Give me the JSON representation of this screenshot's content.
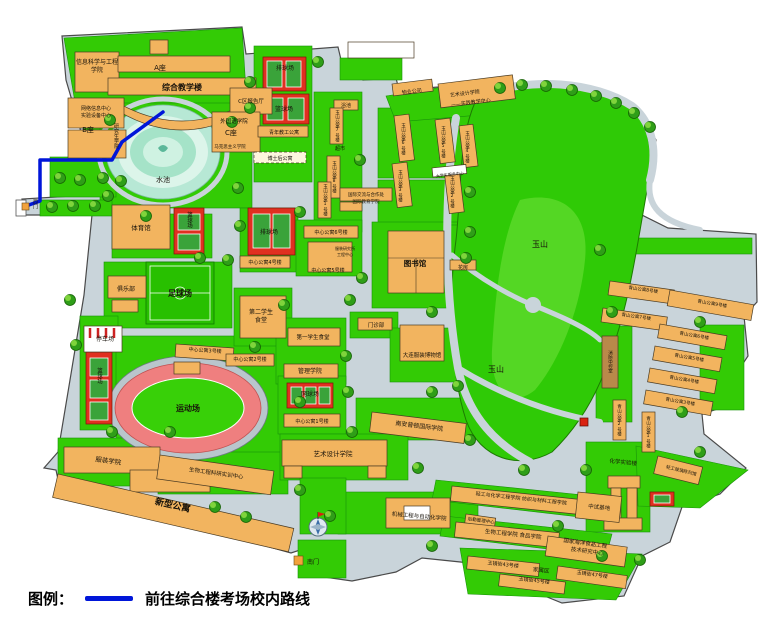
{
  "legend": {
    "prefix": "图例：",
    "route_label": "前往综合楼考场校内路线"
  },
  "colors": {
    "route": "#0016d9",
    "ground": "#c9d4da",
    "green": "#33cb05",
    "building": "#f2b45f",
    "court_red": "#e03020",
    "pond": "#b7e8d5"
  },
  "map": {
    "labels": [
      {
        "t": "信息科学与工程",
        "x": 97,
        "y": 64,
        "fs": 6
      },
      {
        "t": "学院",
        "x": 97,
        "y": 72,
        "fs": 6
      },
      {
        "t": "A座",
        "x": 160,
        "y": 70,
        "fs": 7
      },
      {
        "t": "综合教学楼",
        "x": 182,
        "y": 90,
        "fs": 8,
        "b": 1
      },
      {
        "t": "C区报告厅",
        "x": 251,
        "y": 103,
        "fs": 5.5
      },
      {
        "t": "网络信息中心",
        "x": 96,
        "y": 110,
        "fs": 5
      },
      {
        "t": "实验设备中心",
        "x": 96,
        "y": 117,
        "fs": 5
      },
      {
        "t": "B座",
        "x": 88,
        "y": 132,
        "fs": 7
      },
      {
        "t": "研究生学院",
        "x": 116,
        "y": 136,
        "fs": 5,
        "v": 1
      },
      {
        "t": "外国语学院",
        "x": 234,
        "y": 123,
        "fs": 5.5
      },
      {
        "t": "C座",
        "x": 231,
        "y": 135,
        "fs": 7
      },
      {
        "t": "马克思主义学院",
        "x": 230,
        "y": 148,
        "fs": 4.5
      },
      {
        "t": "水池",
        "x": 163,
        "y": 182,
        "fs": 7,
        "c": "#1c5e4e"
      },
      {
        "t": "西门",
        "x": 35,
        "y": 204,
        "fs": 5,
        "v": 1
      },
      {
        "t": "体育馆",
        "x": 141,
        "y": 230,
        "fs": 6.5
      },
      {
        "t": "篮球场",
        "x": 189,
        "y": 220,
        "fs": 5.5,
        "v": 1,
        "c": "#fff"
      },
      {
        "t": "俱乐部",
        "x": 126,
        "y": 291,
        "fs": 6
      },
      {
        "t": "足球场",
        "x": 180,
        "y": 296,
        "fs": 8,
        "c": "#fff",
        "b": 1
      },
      {
        "t": "停车场",
        "x": 105,
        "y": 341,
        "fs": 6
      },
      {
        "t": "篮球场",
        "x": 99,
        "y": 376,
        "fs": 5.5,
        "v": 1,
        "c": "#fff"
      },
      {
        "t": "运动场",
        "x": 188,
        "y": 411,
        "fs": 8,
        "c": "#7a1800",
        "b": 1
      },
      {
        "t": "服装学院",
        "x": 108,
        "y": 463,
        "fs": 6.5,
        "r": 8
      },
      {
        "t": "生物工程科研实训中心",
        "x": 216,
        "y": 475,
        "fs": 5.5,
        "r": 8
      },
      {
        "t": "新型公寓",
        "x": 172,
        "y": 508,
        "fs": 9,
        "r": 13,
        "b": 1
      },
      {
        "t": "排球场",
        "x": 269,
        "y": 234,
        "fs": 6,
        "c": "#fff"
      },
      {
        "t": "中心公寓4号楼",
        "x": 265,
        "y": 264,
        "fs": 5
      },
      {
        "t": "中心公寓6号楼",
        "x": 331,
        "y": 234,
        "fs": 5
      },
      {
        "t": "中心公寓5号楼",
        "x": 328,
        "y": 272,
        "fs": 5
      },
      {
        "t": "服装研究所",
        "x": 345,
        "y": 250,
        "fs": 4
      },
      {
        "t": "工程中心",
        "x": 345,
        "y": 256,
        "fs": 4
      },
      {
        "t": "图书馆",
        "x": 415,
        "y": 266,
        "fs": 7.5,
        "b": 1
      },
      {
        "t": "花房",
        "x": 463,
        "y": 269,
        "fs": 5
      },
      {
        "t": "第二学生",
        "x": 261,
        "y": 314,
        "fs": 6
      },
      {
        "t": "食堂",
        "x": 261,
        "y": 322,
        "fs": 6
      },
      {
        "t": "第一学生食堂",
        "x": 313,
        "y": 339,
        "fs": 5.5
      },
      {
        "t": "中心公寓3号楼",
        "x": 205,
        "y": 352,
        "fs": 5,
        "r": 4
      },
      {
        "t": "中心公寓2号楼",
        "x": 250,
        "y": 361,
        "fs": 5
      },
      {
        "t": "管理学院",
        "x": 310,
        "y": 373,
        "fs": 6
      },
      {
        "t": "门诊部",
        "x": 376,
        "y": 327,
        "fs": 5.5
      },
      {
        "t": "大连服装博物馆",
        "x": 422,
        "y": 357,
        "fs": 5.5
      },
      {
        "t": "网球场",
        "x": 310,
        "y": 396,
        "fs": 6,
        "c": "#fff"
      },
      {
        "t": "中心公寓1号楼",
        "x": 312,
        "y": 423,
        "fs": 5
      },
      {
        "t": "南安普顿国际学院",
        "x": 419,
        "y": 428,
        "fs": 6,
        "r": 7
      },
      {
        "t": "艺术设计学院",
        "x": 333,
        "y": 456,
        "fs": 6.5
      },
      {
        "t": "机械工程与自动化学院",
        "x": 419,
        "y": 518,
        "fs": 5.5,
        "r": 5
      },
      {
        "t": "后勤管理中心",
        "x": 481,
        "y": 522,
        "fs": 4.5,
        "r": 8
      },
      {
        "t": "南门",
        "x": 313,
        "y": 564,
        "fs": 6
      },
      {
        "t": "排球场",
        "x": 285,
        "y": 70,
        "fs": 6,
        "c": "#fff"
      },
      {
        "t": "篮球场",
        "x": 284,
        "y": 111,
        "fs": 6,
        "c": "#fff"
      },
      {
        "t": "青年教工公寓",
        "x": 284,
        "y": 134,
        "fs": 5
      },
      {
        "t": "博士后公寓",
        "x": 280,
        "y": 160,
        "fs": 5
      },
      {
        "t": "浴池",
        "x": 346,
        "y": 107,
        "fs": 5
      },
      {
        "t": "玉山公寓7号楼",
        "x": 337,
        "y": 126,
        "fs": 4.5,
        "v": 1
      },
      {
        "t": "超市",
        "x": 340,
        "y": 150,
        "fs": 5
      },
      {
        "t": "玉山公寓8号楼",
        "x": 334,
        "y": 177,
        "fs": 4.5,
        "v": 1
      },
      {
        "t": "玉山公寓1号楼",
        "x": 325,
        "y": 200,
        "fs": 4.5,
        "v": 1
      },
      {
        "t": "国际交流与合作处",
        "x": 366,
        "y": 196,
        "fs": 4.5
      },
      {
        "t": "国际教育学院",
        "x": 366,
        "y": 203,
        "fs": 4.5
      },
      {
        "t": "物业公司",
        "x": 412,
        "y": 93,
        "fs": 5,
        "r": -7
      },
      {
        "t": "艺术设计学院",
        "x": 465,
        "y": 95,
        "fs": 5,
        "r": -7
      },
      {
        "t": "——实践教学中心",
        "x": 471,
        "y": 104,
        "fs": 5,
        "r": -7
      },
      {
        "t": "玉山公寓6号楼",
        "x": 403,
        "y": 139,
        "fs": 4.5,
        "v": 1
      },
      {
        "t": "玉山公寓5号楼",
        "x": 443,
        "y": 142,
        "fs": 4.5,
        "v": 1
      },
      {
        "t": "玉山公寓4号楼",
        "x": 467,
        "y": 147,
        "fs": 4.5,
        "v": 1
      },
      {
        "t": "玉山公寓3号楼",
        "x": 400,
        "y": 186,
        "fs": 4.5,
        "v": 1
      },
      {
        "t": "玉山公寓2号楼",
        "x": 452,
        "y": 192,
        "fs": 4.5,
        "v": 1
      },
      {
        "t": "大学生服务中心",
        "x": 450,
        "y": 176,
        "fs": 4,
        "r": -6
      },
      {
        "t": "玉山",
        "x": 540,
        "y": 247,
        "fs": 8
      },
      {
        "t": "玉山",
        "x": 496,
        "y": 372,
        "fs": 8
      },
      {
        "t": "青山公寓8号楼",
        "x": 643,
        "y": 291,
        "fs": 4.5,
        "r": 8
      },
      {
        "t": "青山公寓7号楼",
        "x": 636,
        "y": 318,
        "fs": 4.5,
        "r": 8
      },
      {
        "t": "青山公寓9号楼",
        "x": 712,
        "y": 305,
        "fs": 4.5,
        "r": 10
      },
      {
        "t": "青山公寓6号楼",
        "x": 694,
        "y": 337,
        "fs": 4.5,
        "r": 10
      },
      {
        "t": "青山公寓5号楼",
        "x": 689,
        "y": 359,
        "fs": 4.5,
        "r": 10
      },
      {
        "t": "青山公寓4号楼",
        "x": 684,
        "y": 381,
        "fs": 4.5,
        "r": 10
      },
      {
        "t": "青山公寓3号楼",
        "x": 680,
        "y": 403,
        "fs": 4.5,
        "r": 10
      },
      {
        "t": "青山公寓2号楼",
        "x": 619,
        "y": 420,
        "fs": 4.5,
        "v": 1
      },
      {
        "t": "青山公寓1号楼",
        "x": 648,
        "y": 432,
        "fs": 4.5,
        "v": 1
      },
      {
        "t": "消防中控室",
        "x": 610,
        "y": 362,
        "fs": 4.5,
        "v": 1,
        "c": "#fff"
      },
      {
        "t": "化学实验楼",
        "x": 623,
        "y": 464,
        "fs": 5.5,
        "r": 6
      },
      {
        "t": "轻工玻璃陈列馆",
        "x": 681,
        "y": 472,
        "fs": 4.5,
        "r": 14
      },
      {
        "t": "轻工与化学工程学院  纺织与材料工程学院",
        "x": 521,
        "y": 500,
        "fs": 5,
        "r": 6
      },
      {
        "t": "中试基地",
        "x": 599,
        "y": 509,
        "fs": 5.5,
        "r": 6
      },
      {
        "t": "生物工程学院  食品学院",
        "x": 513,
        "y": 536,
        "fs": 5.5,
        "r": 6
      },
      {
        "t": "国家海洋食品工程",
        "x": 585,
        "y": 545,
        "fs": 5.5,
        "r": 8
      },
      {
        "t": "技术研究中心",
        "x": 587,
        "y": 553,
        "fs": 5.5,
        "r": 8
      },
      {
        "t": "玉镜街43号楼",
        "x": 503,
        "y": 566,
        "fs": 5,
        "r": 6
      },
      {
        "t": "家属区",
        "x": 541,
        "y": 572,
        "fs": 5.5,
        "r": 6
      },
      {
        "t": "玉镜街45号楼",
        "x": 534,
        "y": 582,
        "fs": 5,
        "r": 7
      },
      {
        "t": "玉镜街47号楼",
        "x": 592,
        "y": 576,
        "fs": 5,
        "r": 8
      }
    ]
  }
}
